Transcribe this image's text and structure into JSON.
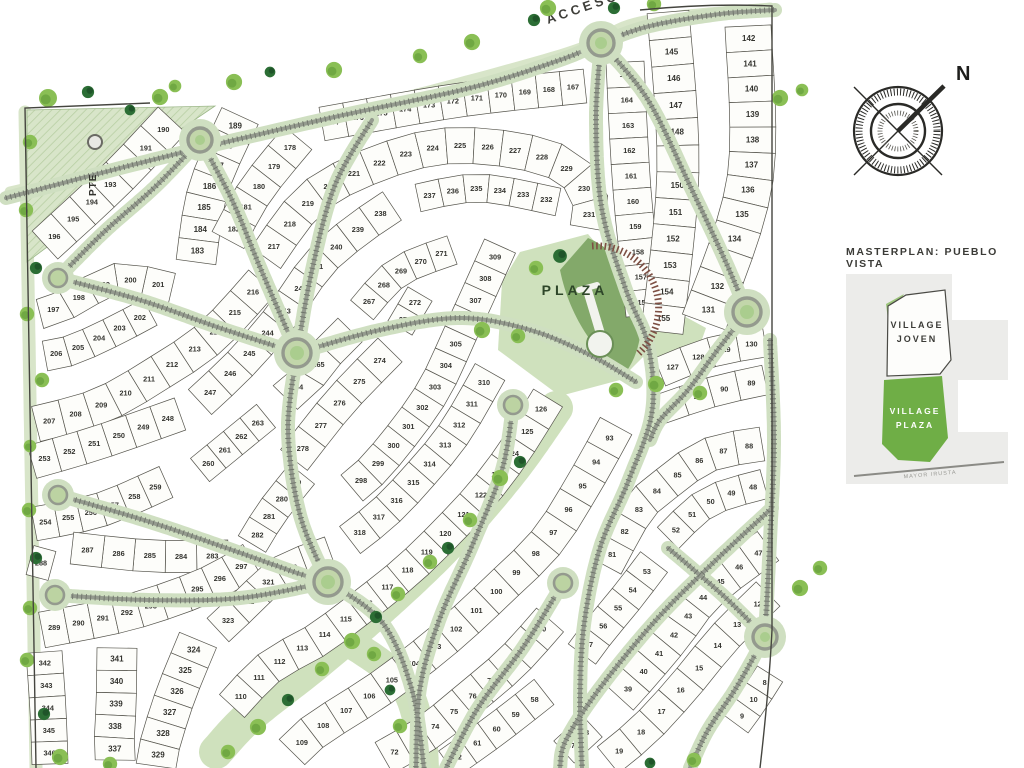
{
  "map": {
    "labels": {
      "acceso": "ACCESO",
      "plaza": "PLAZA",
      "pte": "PTE"
    },
    "strips": [
      {
        "numbers": [
          190,
          191,
          192,
          193,
          194,
          195,
          196
        ],
        "w": 38,
        "spine": [
          [
            172,
            120
          ],
          [
            115,
            180
          ],
          [
            45,
            245
          ]
        ]
      },
      {
        "numbers": [
          189,
          188,
          187,
          186,
          185,
          184,
          183
        ],
        "w": 40,
        "spine": [
          [
            240,
            116
          ],
          [
            208,
            190
          ],
          [
            196,
            262
          ]
        ]
      },
      {
        "numbers": [
          178,
          179,
          180,
          181,
          182
        ],
        "w": 36,
        "spine": [
          [
            298,
            138
          ],
          [
            256,
            190
          ],
          [
            228,
            240
          ]
        ]
      },
      {
        "numbers": [
          177,
          176,
          175,
          174,
          173,
          172,
          171,
          170,
          169,
          168,
          167
        ],
        "w": 34,
        "spine": [
          [
            322,
            124
          ],
          [
            460,
            100
          ],
          [
            585,
            86
          ]
        ]
      },
      {
        "numbers": [
          165,
          164,
          163,
          162,
          161,
          160,
          159,
          158,
          157,
          156
        ],
        "w": 38,
        "spine": [
          [
            625,
            62
          ],
          [
            632,
            190
          ],
          [
            645,
            315
          ]
        ]
      },
      {
        "numbers": [
          166,
          145,
          146,
          147,
          148,
          149,
          150,
          151,
          152,
          153,
          154,
          155
        ],
        "w": 42,
        "spine": [
          [
            668,
            12
          ],
          [
            678,
            170
          ],
          [
            662,
            332
          ]
        ]
      },
      {
        "numbers": [
          142,
          141,
          140,
          139,
          138,
          137,
          136,
          135,
          134,
          133,
          132,
          131
        ],
        "w": 46,
        "spine": [
          [
            748,
            26
          ],
          [
            750,
            180
          ],
          [
            704,
            322
          ]
        ]
      },
      {
        "numbers": [
          130,
          129,
          128,
          127
        ],
        "w": 30,
        "spine": [
          [
            765,
            342
          ],
          [
            712,
            352
          ],
          [
            660,
            372
          ]
        ]
      },
      {
        "numbers": [
          89,
          90,
          91,
          92
        ],
        "w": 30,
        "spine": [
          [
            765,
            380
          ],
          [
            712,
            392
          ],
          [
            658,
            410
          ]
        ]
      },
      {
        "numbers": [
          201,
          200,
          199,
          198,
          197
        ],
        "w": 30,
        "spine": [
          [
            172,
            288
          ],
          [
            120,
            278
          ],
          [
            88,
            292
          ],
          [
            60,
            308
          ],
          [
            40,
            314
          ]
        ]
      },
      {
        "numbers": [
          202,
          203,
          204,
          205,
          206
        ],
        "w": 30,
        "spine": [
          [
            150,
            312
          ],
          [
            112,
            332
          ],
          [
            72,
            350
          ],
          [
            45,
            356
          ]
        ]
      },
      {
        "numbers": [
          207,
          208,
          209,
          210,
          211,
          212,
          213,
          214,
          215,
          216
        ],
        "w": 36,
        "spine": [
          [
            36,
            424
          ],
          [
            100,
            406
          ],
          [
            160,
            372
          ],
          [
            212,
            336
          ],
          [
            262,
            282
          ]
        ]
      },
      {
        "numbers": [
          217,
          218,
          219,
          220,
          221,
          222,
          223,
          224,
          225,
          226,
          227,
          228,
          229,
          230,
          231
        ],
        "w": 36,
        "spine": [
          [
            266,
            258
          ],
          [
            320,
            192
          ],
          [
            420,
            150
          ],
          [
            500,
            148
          ],
          [
            566,
            166
          ],
          [
            590,
            200
          ],
          [
            588,
            228
          ]
        ]
      },
      {
        "numbers": [
          237,
          236,
          235,
          234,
          233,
          232
        ],
        "w": 28,
        "spine": [
          [
            418,
            198
          ],
          [
            480,
            188
          ],
          [
            558,
            202
          ]
        ]
      },
      {
        "numbers": [
          247,
          246,
          245,
          244,
          243,
          242,
          241,
          240,
          239,
          238
        ],
        "w": 34,
        "spine": [
          [
            200,
            402
          ],
          [
            240,
            364
          ],
          [
            280,
            318
          ],
          [
            320,
            262
          ],
          [
            360,
            228
          ],
          [
            392,
            206
          ]
        ]
      },
      {
        "numbers": [
          248,
          249,
          250,
          251,
          252,
          253
        ],
        "w": 34,
        "spine": [
          [
            180,
            414
          ],
          [
            100,
            442
          ],
          [
            32,
            462
          ]
        ]
      },
      {
        "numbers": [
          254,
          255,
          256,
          257,
          258,
          259
        ],
        "w": 34,
        "spine": [
          [
            34,
            524
          ],
          [
            100,
            510
          ],
          [
            166,
            482
          ]
        ]
      },
      {
        "numbers": [
          260,
          261,
          262,
          263
        ],
        "w": 30,
        "spine": [
          [
            200,
            470
          ],
          [
            266,
            416
          ]
        ]
      },
      {
        "numbers": [
          266,
          265,
          264
        ],
        "w": 34,
        "spine": [
          [
            350,
            330
          ],
          [
            316,
            366
          ],
          [
            294,
            404
          ]
        ]
      },
      {
        "numbers": [
          271,
          270,
          269,
          268,
          267
        ],
        "w": 30,
        "spine": [
          [
            452,
            250
          ],
          [
            398,
            272
          ],
          [
            362,
            310
          ]
        ]
      },
      {
        "numbers": [
          272,
          273
        ],
        "w": 28,
        "spine": [
          [
            420,
            294
          ],
          [
            400,
            328
          ]
        ]
      },
      {
        "numbers": [
          274,
          275,
          276,
          277,
          278
        ],
        "w": 34,
        "spine": [
          [
            390,
            350
          ],
          [
            340,
            402
          ],
          [
            294,
            460
          ]
        ]
      },
      {
        "numbers": [
          279,
          280,
          281,
          282
        ],
        "w": 32,
        "spine": [
          [
            302,
            474
          ],
          [
            272,
            512
          ],
          [
            252,
            544
          ]
        ]
      },
      {
        "numbers": [
          283,
          284,
          285,
          286,
          287
        ],
        "w": 32,
        "spine": [
          [
            228,
            556
          ],
          [
            150,
            556
          ],
          [
            72,
            548
          ]
        ]
      },
      {
        "numbers": [
          288
        ],
        "w": 30,
        "spine": [
          [
            30,
            560
          ],
          [
            52,
            566
          ]
        ]
      },
      {
        "numbers": [
          289,
          290,
          291,
          292,
          293,
          294,
          295,
          296,
          297
        ],
        "w": 36,
        "spine": [
          [
            42,
            630
          ],
          [
            130,
            612
          ],
          [
            205,
            586
          ],
          [
            252,
            560
          ]
        ]
      },
      {
        "numbers": [
          309,
          308,
          307,
          306,
          305,
          304,
          303,
          302,
          301,
          300,
          299,
          298
        ],
        "w": 34,
        "spine": [
          [
            500,
            246
          ],
          [
            462,
            330
          ],
          [
            430,
            396
          ],
          [
            380,
            462
          ],
          [
            352,
            488
          ]
        ]
      },
      {
        "numbers": [
          310,
          311,
          312,
          313,
          314,
          315,
          316,
          317,
          318
        ],
        "w": 34,
        "spine": [
          [
            490,
            372
          ],
          [
            455,
            432
          ],
          [
            420,
            475
          ],
          [
            385,
            512
          ],
          [
            350,
            540
          ]
        ]
      },
      {
        "numbers": [
          319,
          320,
          321,
          322,
          323
        ],
        "w": 32,
        "spine": [
          [
            330,
            552
          ],
          [
            280,
            572
          ],
          [
            250,
            600
          ],
          [
            218,
            630
          ]
        ]
      },
      {
        "numbers": [
          324,
          325,
          326,
          327,
          328,
          329
        ],
        "w": 40,
        "spine": [
          [
            198,
            640
          ],
          [
            176,
            694
          ],
          [
            160,
            744
          ],
          [
            156,
            766
          ]
        ]
      },
      {
        "numbers": [
          341,
          340,
          339,
          338,
          337
        ],
        "w": 40,
        "spine": [
          [
            117,
            648
          ],
          [
            116,
            706
          ],
          [
            113,
            760
          ]
        ]
      },
      {
        "numbers": [
          342,
          343,
          344,
          345,
          346
        ],
        "w": 36,
        "spine": [
          [
            44,
            652
          ],
          [
            48,
            710
          ],
          [
            50,
            764
          ]
        ]
      },
      {
        "numbers": [
          126,
          125,
          124,
          123,
          122,
          121,
          120,
          119,
          118,
          117,
          116,
          115,
          114,
          113,
          112,
          111,
          110
        ],
        "w": 34,
        "spine": [
          [
            548,
            398
          ],
          [
            516,
            449
          ],
          [
            484,
            492
          ],
          [
            447,
            532
          ],
          [
            409,
            569
          ],
          [
            367,
            603
          ],
          [
            317,
            640
          ],
          [
            270,
            667
          ],
          [
            232,
            706
          ]
        ]
      },
      {
        "numbers": [
          93,
          94,
          95,
          96,
          97,
          98,
          99,
          100,
          101,
          102,
          103,
          104,
          105,
          106,
          107,
          108,
          109
        ],
        "w": 36,
        "spine": [
          [
            616,
            426
          ],
          [
            586,
            480
          ],
          [
            548,
            540
          ],
          [
            500,
            588
          ],
          [
            448,
            636
          ],
          [
            384,
            686
          ],
          [
            316,
            730
          ],
          [
            292,
            752
          ]
        ]
      },
      {
        "numbers": [
          88,
          87,
          86,
          85,
          84,
          83,
          82,
          81
        ],
        "w": 34,
        "spine": [
          [
            762,
            444
          ],
          [
            706,
            456
          ],
          [
            656,
            492
          ],
          [
            636,
            512
          ],
          [
            606,
            566
          ]
        ]
      },
      {
        "numbers": [
          48,
          49,
          50,
          51,
          52
        ],
        "w": 30,
        "spine": [
          [
            764,
            484
          ],
          [
            708,
            502
          ],
          [
            668,
            538
          ]
        ]
      },
      {
        "numbers": [
          47,
          46,
          45,
          44,
          43,
          42,
          41,
          40,
          39
        ],
        "w": 36,
        "spine": [
          [
            768,
            546
          ],
          [
            708,
            592
          ],
          [
            672,
            638
          ],
          [
            638,
            678
          ],
          [
            620,
            698
          ]
        ]
      },
      {
        "numbers": [
          12,
          13,
          14,
          15,
          16,
          17,
          18,
          19
        ],
        "w": 34,
        "spine": [
          [
            768,
            594
          ],
          [
            724,
            638
          ],
          [
            686,
            684
          ],
          [
            646,
            728
          ],
          [
            608,
            760
          ]
        ]
      },
      {
        "numbers": [
          8,
          10,
          9
        ],
        "w": 30,
        "spine": [
          [
            770,
            674
          ],
          [
            752,
            702
          ],
          [
            736,
            724
          ]
        ]
      },
      {
        "numbers": [
          53,
          54,
          55,
          56,
          57
        ],
        "w": 34,
        "spine": [
          [
            654,
            562
          ],
          [
            628,
            596
          ],
          [
            600,
            630
          ],
          [
            582,
            654
          ]
        ]
      },
      {
        "numbers": [
          80,
          79,
          78,
          77,
          76,
          75,
          74,
          73,
          72
        ],
        "w": 36,
        "spine": [
          [
            550,
            620
          ],
          [
            512,
            662
          ],
          [
            470,
            698
          ],
          [
            428,
            732
          ],
          [
            384,
            758
          ]
        ]
      },
      {
        "numbers": [
          58,
          59,
          60,
          61,
          62
        ],
        "w": 32,
        "spine": [
          [
            544,
            692
          ],
          [
            498,
            728
          ],
          [
            448,
            764
          ]
        ]
      },
      {
        "numbers": [
          38,
          37
        ],
        "w": 30,
        "spine": [
          [
            592,
            726
          ],
          [
            564,
            752
          ]
        ]
      }
    ]
  },
  "compass": {
    "north_label": "N"
  },
  "sidebar": {
    "title": "MASTERPLAN: PUEBLO VISTA",
    "legend": {
      "joven_line1": "VILLAGE",
      "joven_line2": "JOVEN",
      "plaza_line1": "VILLAGE",
      "plaza_line2": "PLAZA",
      "street": "MAYOR IRUSTA"
    }
  },
  "colors": {
    "road_band": "#cfdfc1",
    "road_core": "#949a8e",
    "road_tick": "#6e746a",
    "green_strip": "#d8e5c9",
    "plaza_light": "#cfe1bd",
    "plaza_fan": "#83a96a",
    "hatch": "#7d4f43",
    "tree_light": "#8abf55",
    "tree_mid": "#69a23e",
    "tree_dark": "#2c6e35",
    "boundary": "#45453f",
    "text_dark": "#33332e",
    "legend_green": "#6fae46",
    "card_gray": "#ececea"
  }
}
